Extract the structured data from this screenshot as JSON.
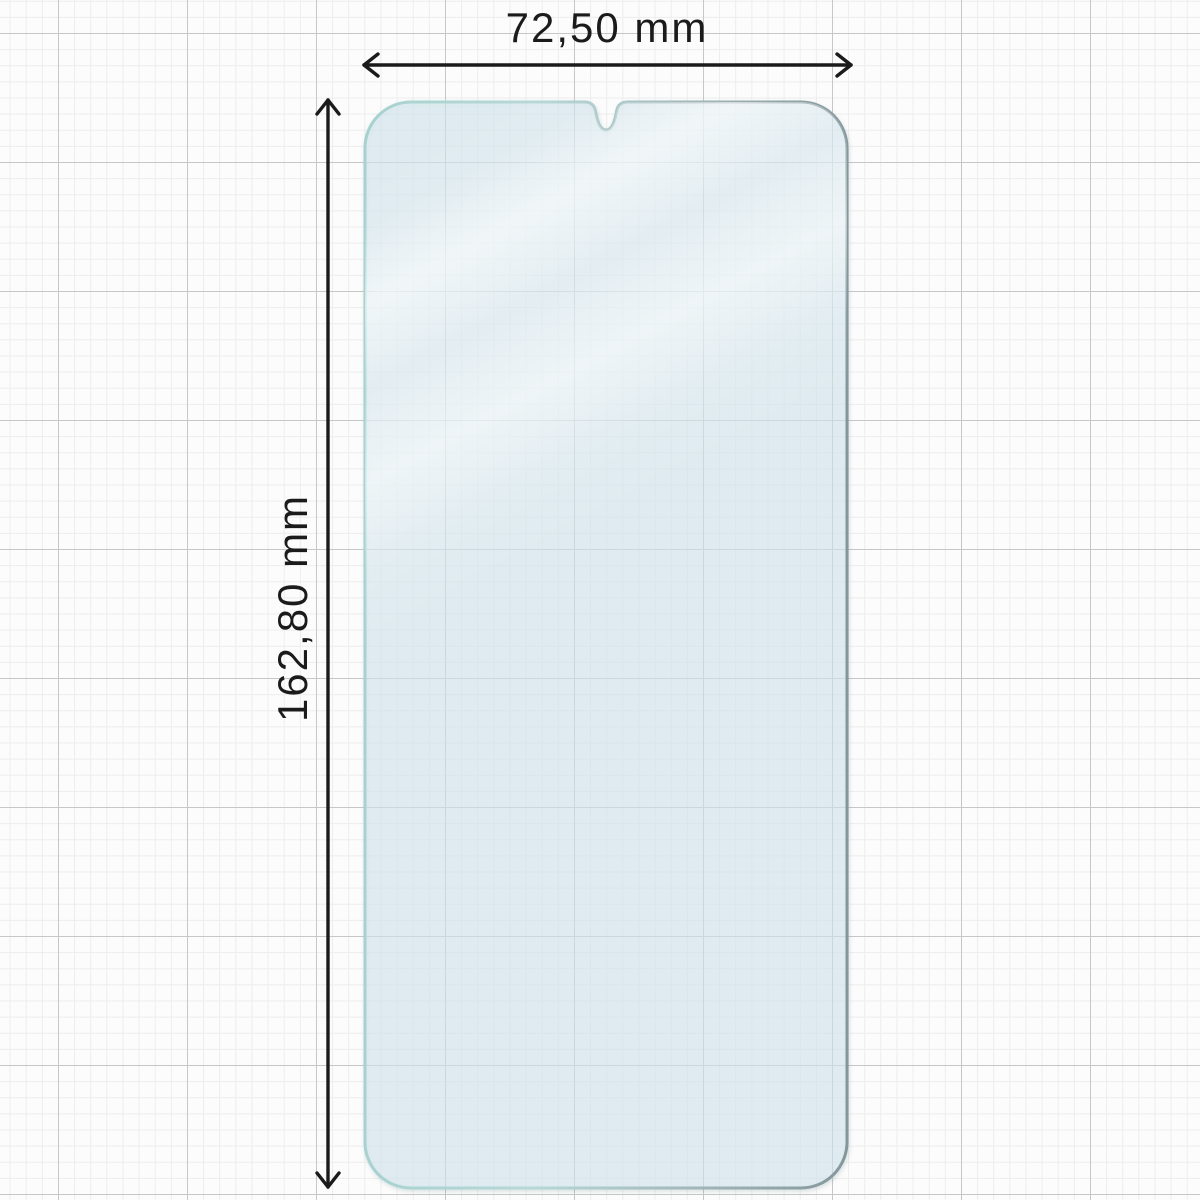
{
  "diagram": {
    "subject": "phone-screen-protector-outline",
    "dimensions": {
      "width_label": "72,50 mm",
      "height_label": "162,80 mm"
    }
  },
  "icons": [
    {
      "name": "width-dimension-arrow",
      "glyph": "double-headed-horizontal-arrow"
    },
    {
      "name": "height-dimension-arrow",
      "glyph": "double-headed-vertical-arrow"
    },
    {
      "name": "camera-notch",
      "glyph": "u-shaped-notch-top-center"
    }
  ],
  "colors": {
    "background": "#fcfcfc",
    "grid_minor": "#ededed",
    "grid_major": "#c7c7c7",
    "dimension_ink": "#1b1b1b",
    "glass_tint": "#d5e9f0",
    "glass_edge_teal": "#a7d2d0",
    "glass_edge_slate": "#84979c",
    "glass_reflection": "#ffffff"
  }
}
